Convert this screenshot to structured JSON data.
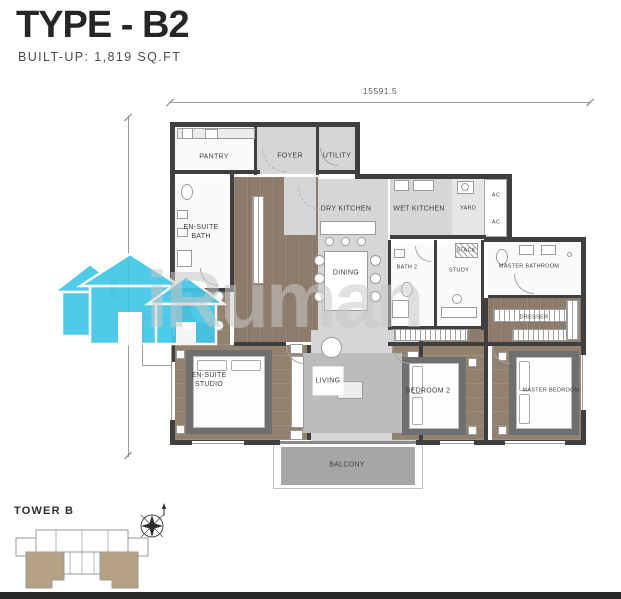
{
  "header": {
    "title": "TYPE - B2",
    "subtitle": "BUILT-UP: 1,819 SQ.FT"
  },
  "dimensions": {
    "top_width": "15591.5",
    "left_height": "13557"
  },
  "rooms": {
    "pantry": "PANTRY",
    "foyer": "FOYER",
    "utility": "UTILITY",
    "ensuite_bath": "EN-SUITE\nBATH",
    "dry_kitchen": "DRY KITCHEN",
    "wet_kitchen": "WET KITCHEN",
    "yard": "YARD",
    "ac": "AC",
    "dining": "DINING",
    "bath2": "BATH 2",
    "study": "STUDY",
    "stack": "STACK",
    "master_bathroom": "MASTER BATHROOM",
    "dresser": "DRESSER",
    "ensuite_studio": "EN-SUITE\nSTUDIO",
    "living": "LIVING",
    "bedroom2": "BEDROOM 2",
    "master_bedroom": "MASTER BEDROOM",
    "balcony": "BALCONY"
  },
  "keyplan": {
    "tower_label": "TOWER B"
  },
  "watermark": {
    "text": "iRuman",
    "house_color": "#41c6e8"
  },
  "colors": {
    "wall": "#3f3f3f",
    "floor_light": "#d6d6d6",
    "floor_wood": "#8d7b6b",
    "balcony": "#a6a6a6",
    "keyplan_highlight": "#b5a284"
  }
}
